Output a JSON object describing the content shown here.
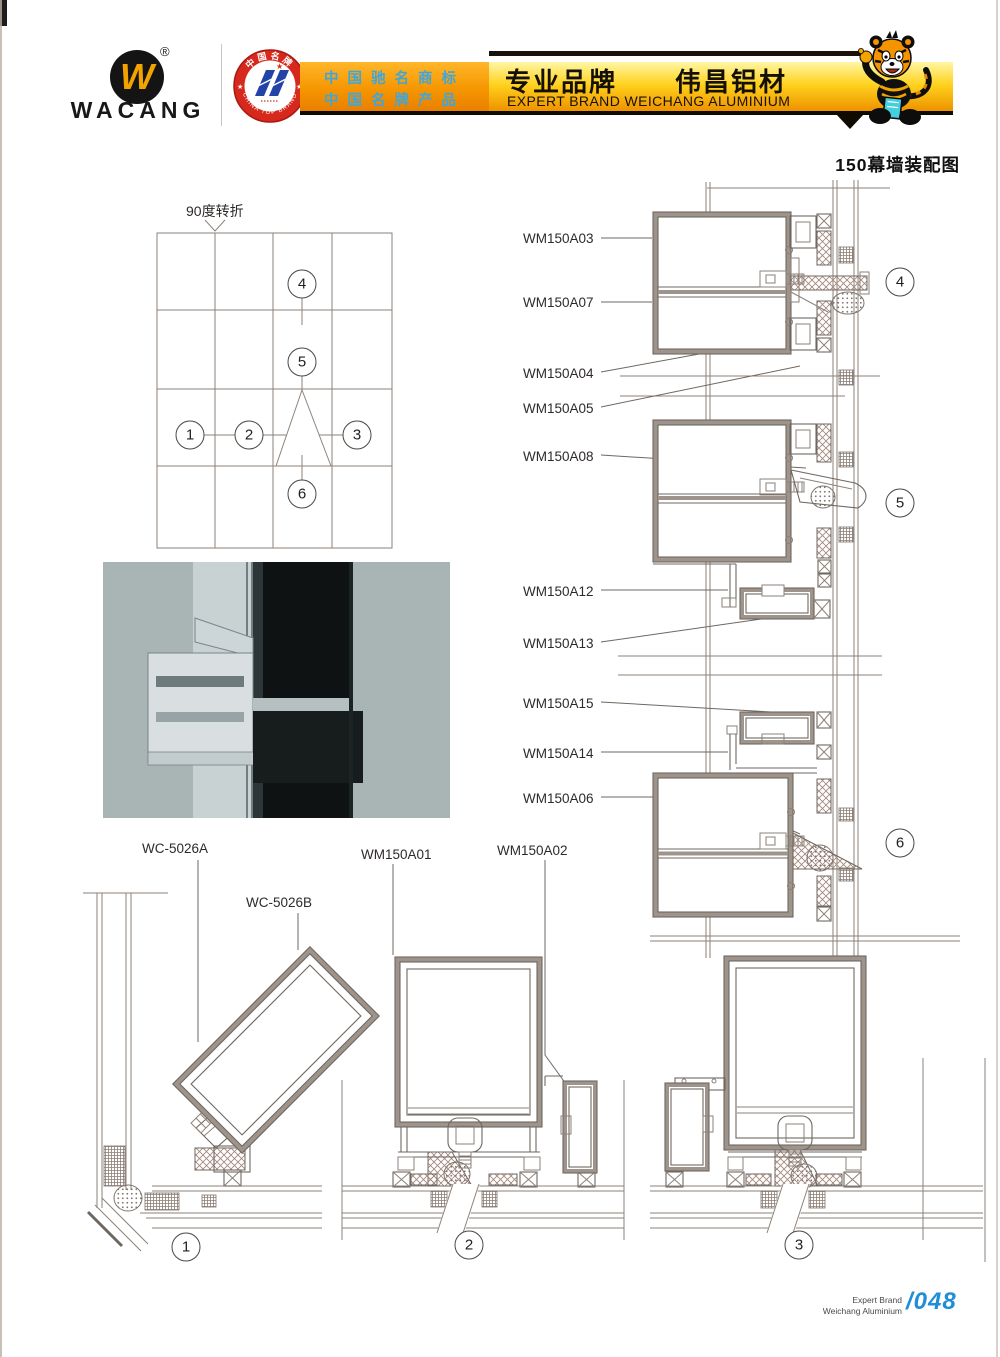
{
  "header": {
    "logo_text": "WACANG",
    "registered_mark": "®",
    "badge": {
      "arc_top": "中国名牌",
      "arc_bottom": "CHINA TOP BRAND"
    },
    "banner_left": {
      "line1": "中国驰名商标",
      "line2": "中国名牌产品"
    },
    "banner_right": {
      "cn_left": "专业品牌",
      "cn_right": "伟昌铝材",
      "en": "EXPERT BRAND WEICHANG ALUMINIUM"
    }
  },
  "page_title": "150幕墙装配图",
  "grid_diagram": {
    "corner_label": "90度转折"
  },
  "callouts": {
    "c1": "1",
    "c2": "2",
    "c3": "3",
    "c4": "4",
    "c5": "5",
    "c6": "6"
  },
  "part_labels": {
    "a03": "WM150A03",
    "a07": "WM150A07",
    "a04": "WM150A04",
    "a05": "WM150A05",
    "a08": "WM150A08",
    "a12": "WM150A12",
    "a13": "WM150A13",
    "a15": "WM150A15",
    "a14": "WM150A14",
    "a06": "WM150A06",
    "wc_a": "WC-5026A",
    "wc_b": "WC-5026B",
    "a01": "WM150A01",
    "a02": "WM150A02"
  },
  "footer": {
    "brand_line1": "Expert Brand",
    "brand_line2": "Weichang Aluminium",
    "page_number": "/048"
  },
  "colors": {
    "banner_orange": "#f59600",
    "banner_yellow": "#ffd21e",
    "blue_banner_text": "#3fa6dc",
    "logo_yellow": "#f2a300",
    "badge_red": "#d7281d",
    "page_number_blue": "#1f8ed8",
    "drawing_line": "#847970"
  }
}
